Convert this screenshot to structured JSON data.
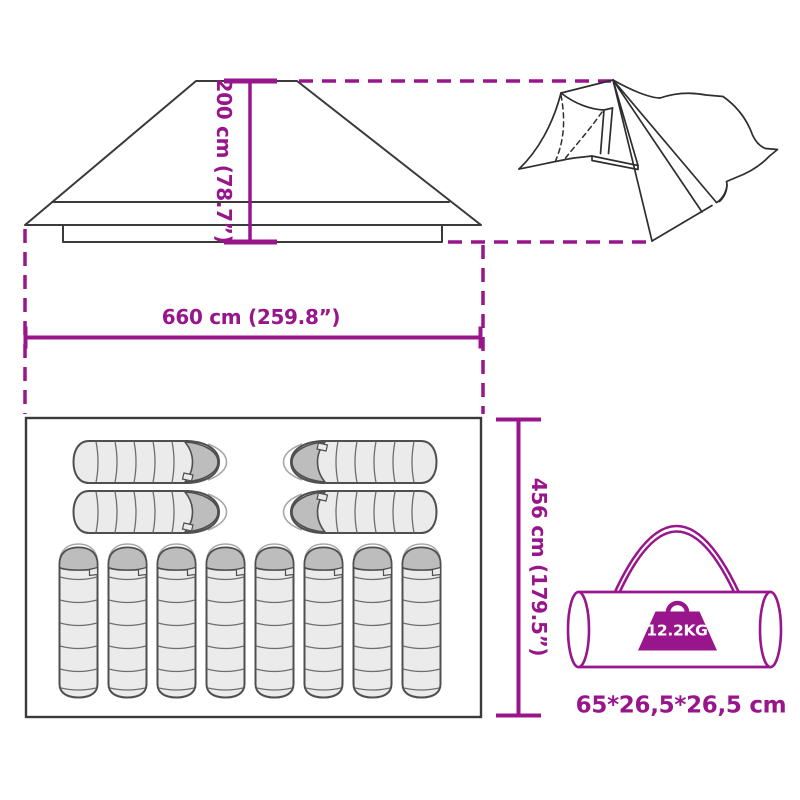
{
  "diagram": {
    "height_label": "200 cm (78.7”)",
    "width_label": "660 cm (259.8”)",
    "depth_label": "456 cm (179.5”)",
    "weight_label": "12.2KG",
    "carry_bag_size_label": "65*26,5*26,5 cm",
    "floor_plan": {
      "horizontal_sleeping_bags": 4,
      "vertical_sleeping_bags": 8
    }
  },
  "colors": {
    "accent_magenta": "#98158c",
    "sketch_line": "#2e2e2e",
    "sleeping_bag_fill": "#ebebeb",
    "sleeping_bag_hood": "#bdbdbd",
    "sleeping_bag_outline": "#4f4f4f"
  }
}
